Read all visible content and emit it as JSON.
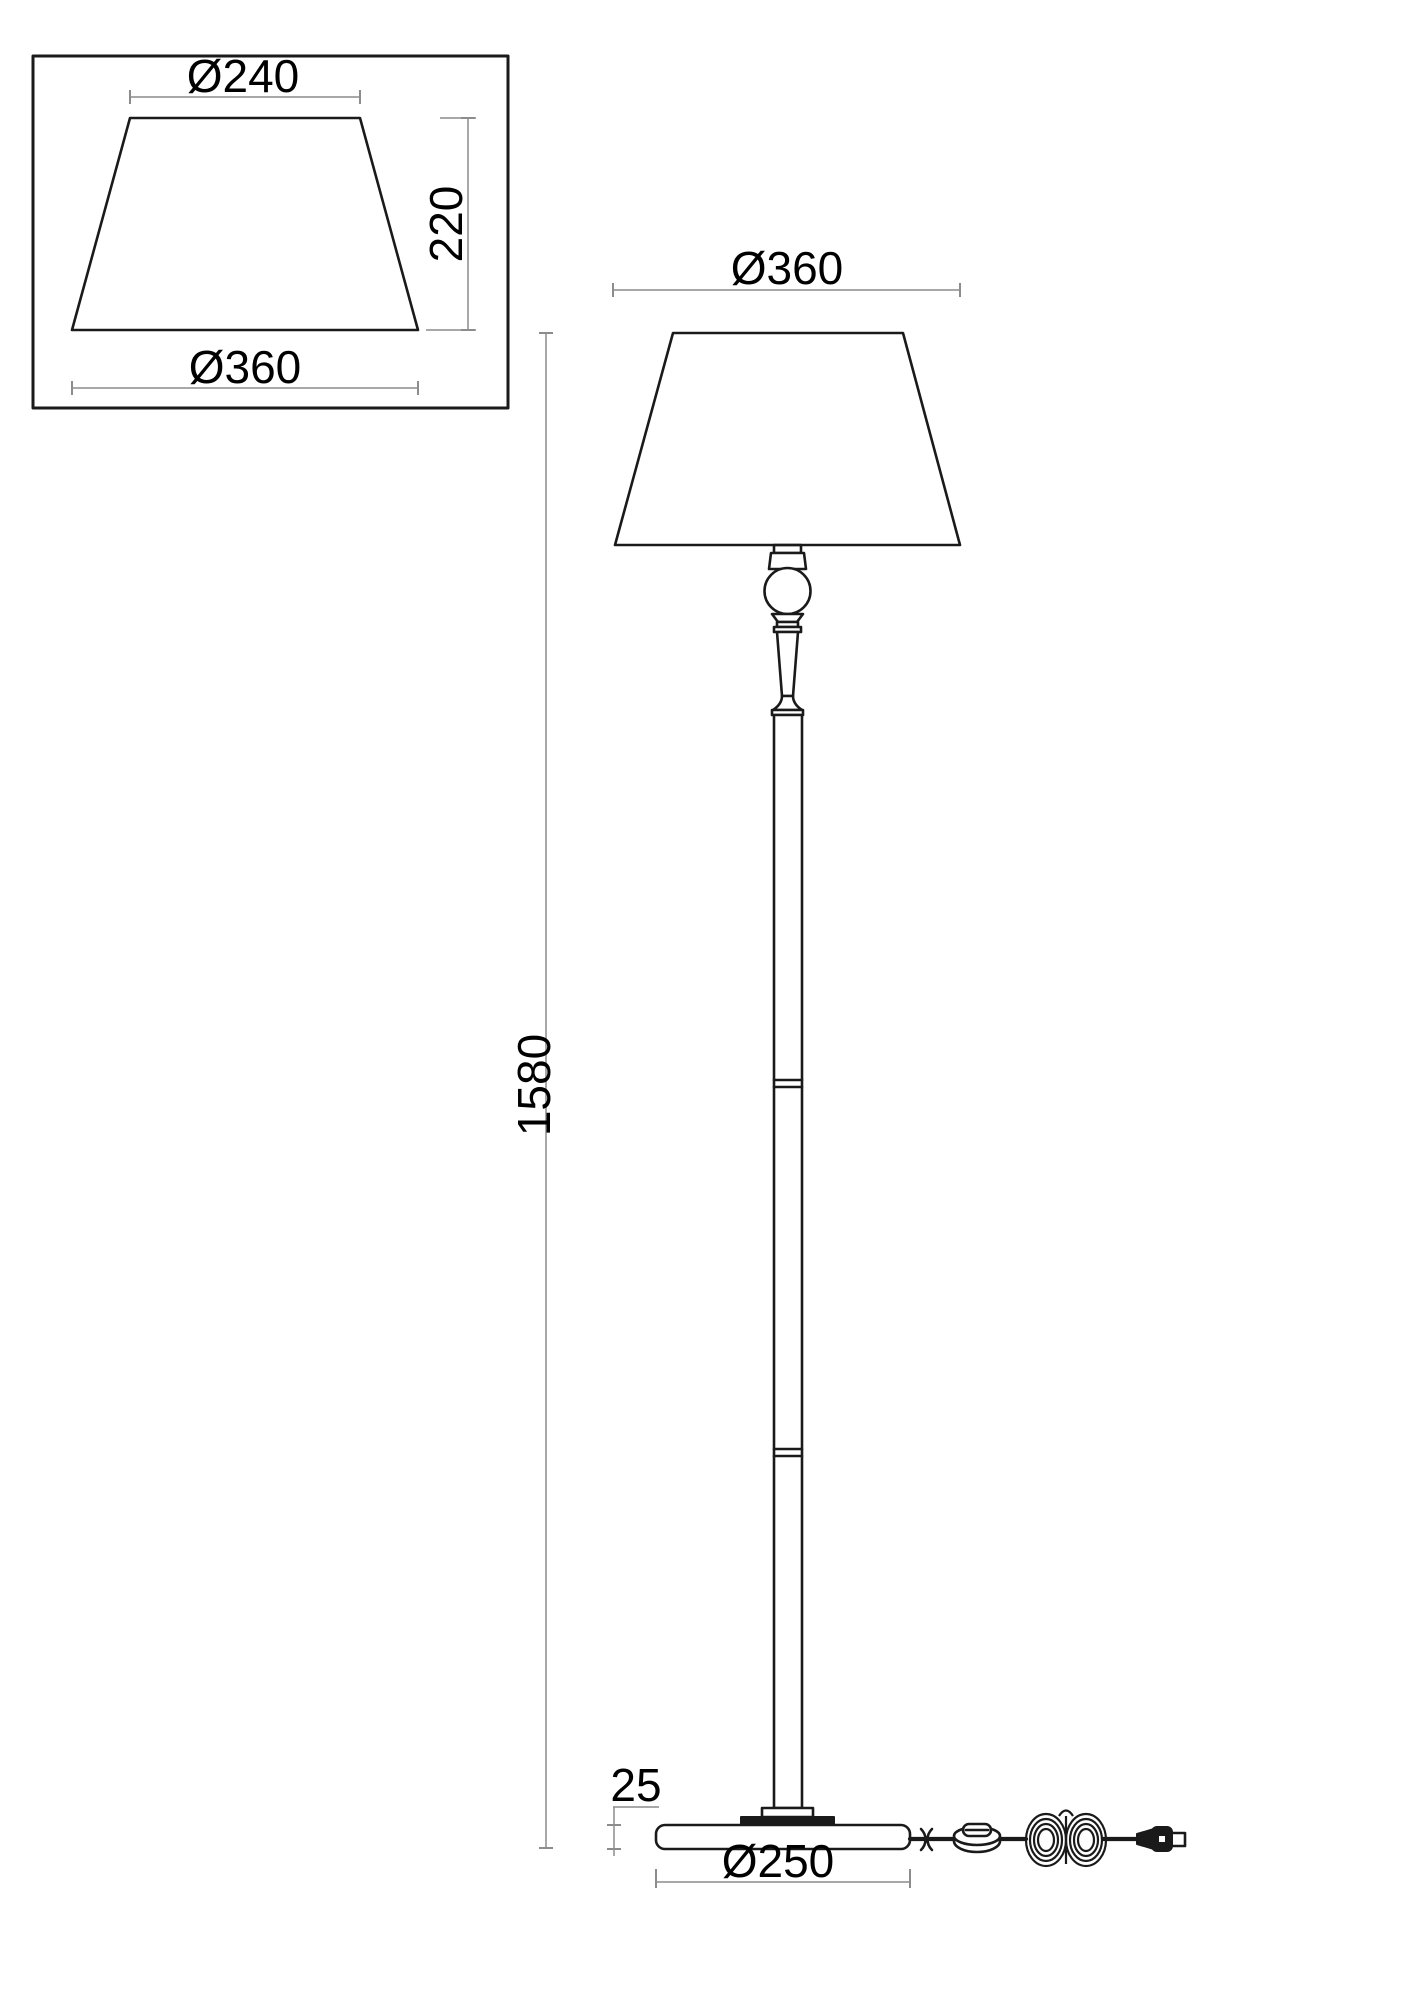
{
  "page": {
    "background": "#ffffff"
  },
  "colors": {
    "object_line": "#1a1a1a",
    "dimension_line": "#8c8c8c",
    "text": "#000000"
  },
  "detail_view": {
    "top_diameter_label": "Ø240",
    "height_label": "220",
    "bottom_diameter_label": "Ø360"
  },
  "main_view": {
    "shade_diameter_label": "Ø360",
    "total_height_label": "1580",
    "base_height_label": "25",
    "base_diameter_label": "Ø250"
  }
}
